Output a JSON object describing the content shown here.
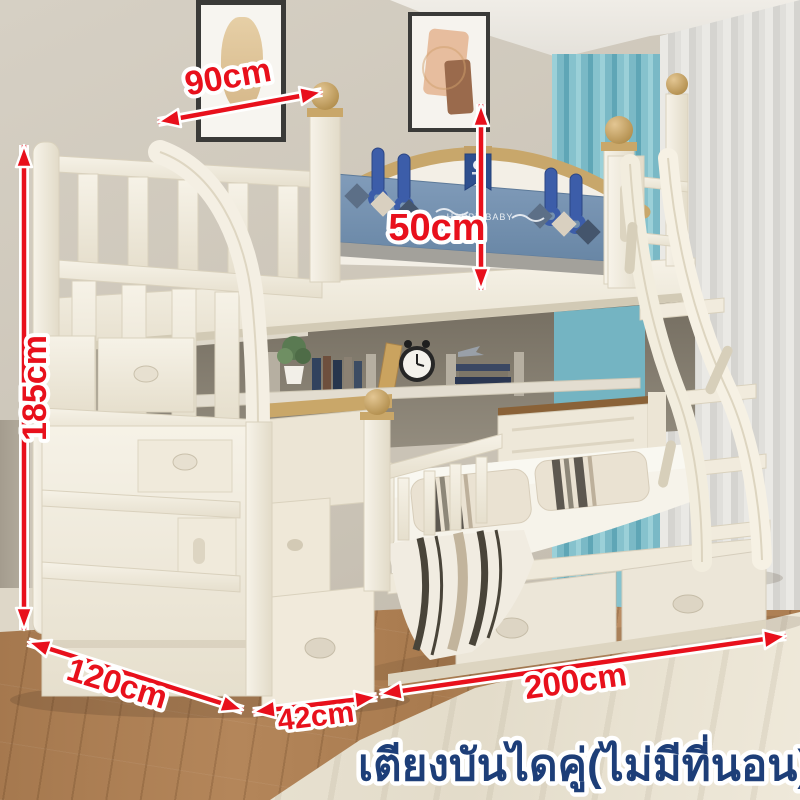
{
  "scene": {
    "type": "product-photo",
    "subject": "kids bunk bed with storage staircase, ladder and under-bed drawers",
    "caption": "เตียงบันไดคู่(ไม่มีที่นอน)",
    "headboard_text": "HAPPY BABY",
    "dimensions": {
      "top_width": "90cm",
      "guard_height": "50cm",
      "total_height": "185cm",
      "depth": "120cm",
      "stair_width": "42cm",
      "length": "200cm"
    },
    "colors": {
      "annotation_red": "#e8101c",
      "caption_navy": "#1d3e78",
      "caption_outline": "#ffffff",
      "wall_beige": "#cac3b6",
      "curtain_teal": "#7ab9c6",
      "curtain_sheer": "#dcdbd7",
      "floor_wood": "#ab7d52",
      "rug_cream": "#e9e3d4",
      "bed_cream": "#f2ede1",
      "trim_tan": "#c8a76b",
      "panel_blue": "#7590b0",
      "hook_blue": "#3c5da9"
    }
  }
}
